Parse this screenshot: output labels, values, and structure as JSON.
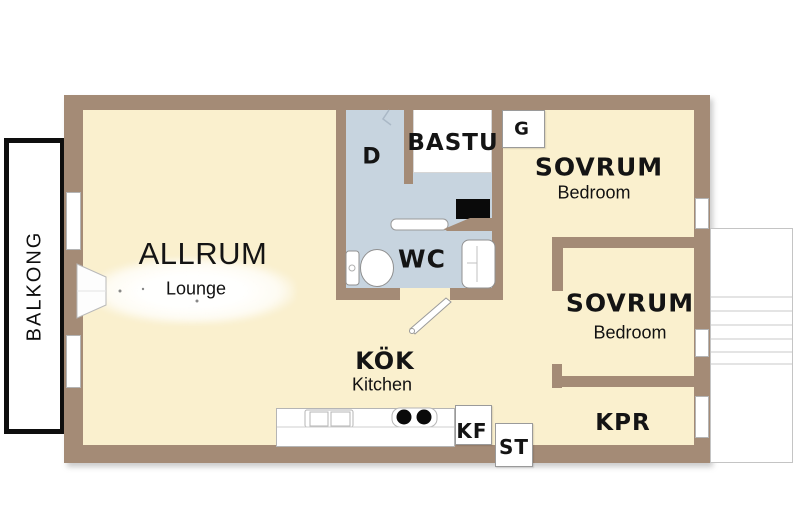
{
  "plan_type": "apartment-floor-plan",
  "colors": {
    "wall": "#a48b76",
    "floor": "#faf0ce",
    "wet_room": "#c7d4df",
    "balcony_border": "#0e0e0e",
    "text": "#141414"
  },
  "balcony": {
    "label": "BALKONG"
  },
  "rooms": {
    "allrum": {
      "sv": "ALLRUM",
      "en": "Lounge"
    },
    "kok": {
      "sv": "KÖK",
      "en": "Kitchen"
    },
    "sovrum1": {
      "sv": "SOVRUM",
      "en": "Bedroom"
    },
    "sovrum2": {
      "sv": "SOVRUM",
      "en": "Bedroom"
    },
    "wc": {
      "sv": "WC"
    },
    "bastu": {
      "sv": "BASTU"
    },
    "shower": {
      "sv": "D"
    },
    "wardrobe": {
      "sv": "G"
    },
    "kpr": {
      "sv": "KPR"
    },
    "fridge_freezer": {
      "sv": "KF"
    },
    "cleaning_closet": {
      "sv": "ST"
    }
  },
  "fixtures": [
    "toilet-icon",
    "bathroom-sink-icon",
    "washing-machine-icon",
    "bench-icon",
    "kitchen-sink-icon",
    "stove-burners-icon",
    "door-swing-icon",
    "balcony-door-icon",
    "staircase-icon",
    "window-icon"
  ]
}
